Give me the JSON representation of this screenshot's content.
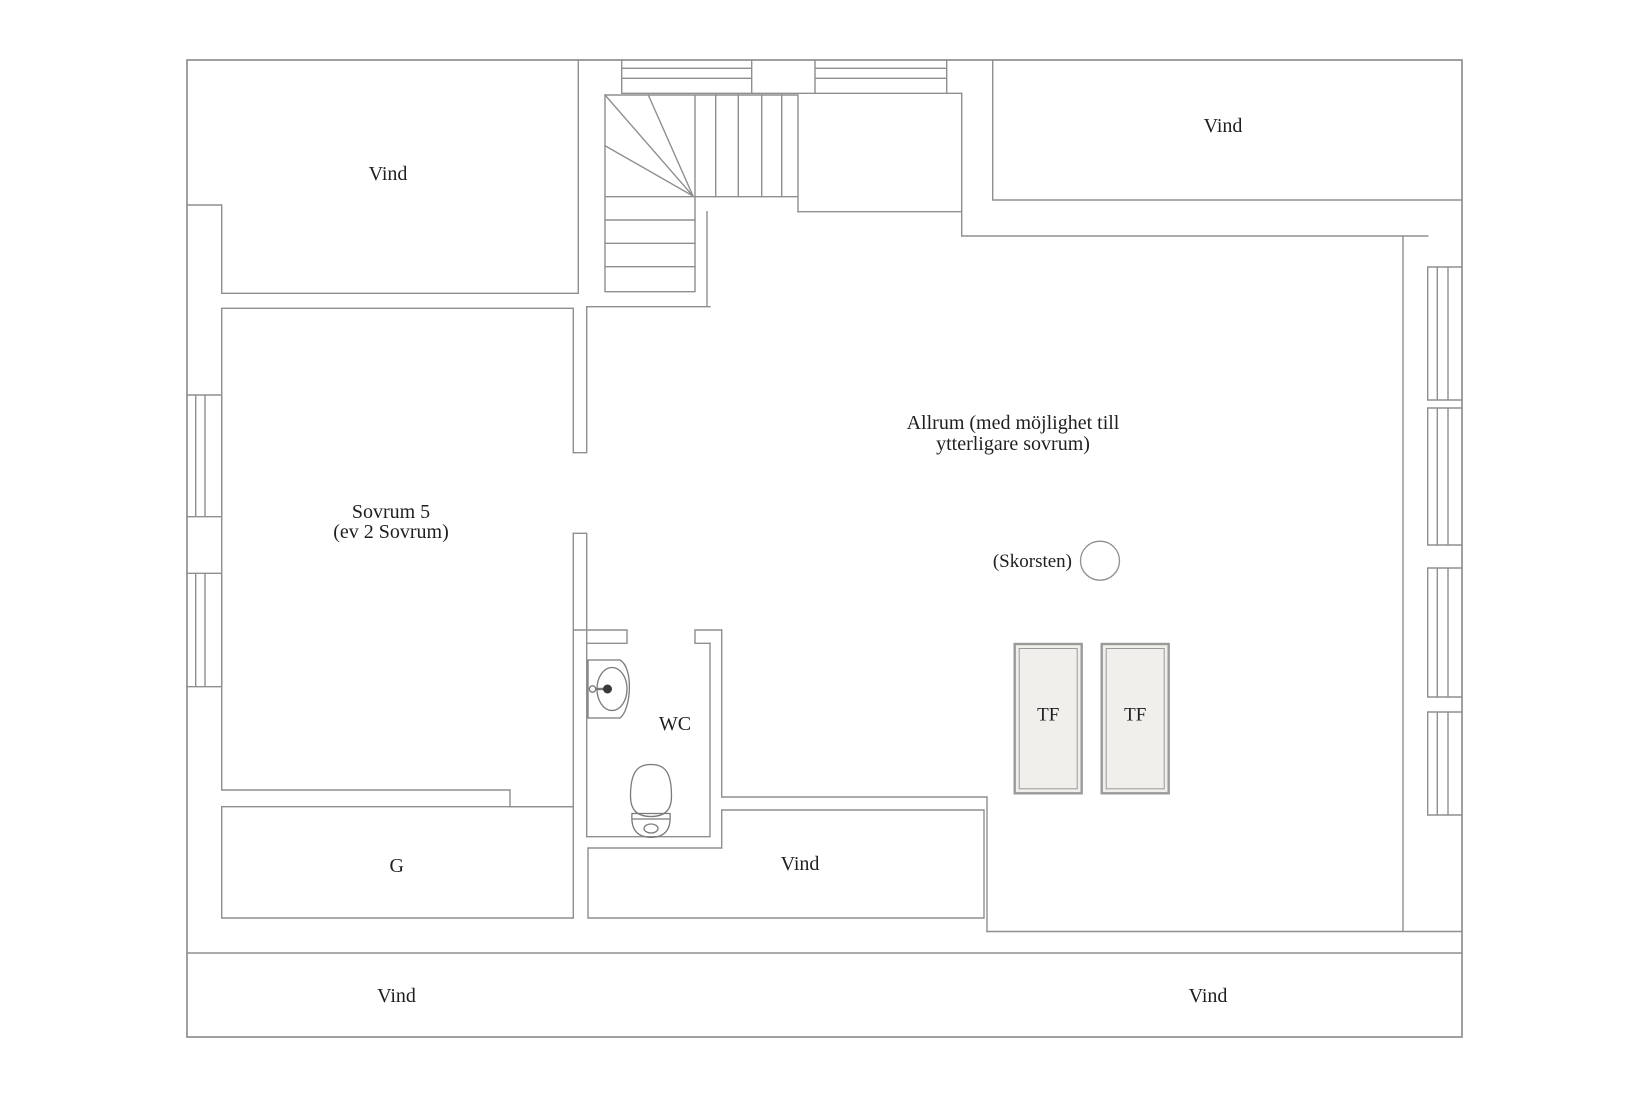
{
  "colors": {
    "wall": "#8f8f8f",
    "fixture": "#7a7a7a",
    "text": "#1f1f1f",
    "skylight_fill": "#f0efec",
    "skylight_border": "#9a9a9a",
    "background": "#ffffff"
  },
  "labels": {
    "vind_top_left": "Vind",
    "vind_top_right": "Vind",
    "sovrum_line1": "Sovrum 5",
    "sovrum_line2": "(ev 2 Sovrum)",
    "allrum_line1": "Allrum (med möjlighet till",
    "allrum_line2": "ytterligare sovrum)",
    "skorsten": "(Skorsten)",
    "wc": "WC",
    "tf_left": "TF",
    "tf_right": "TF",
    "garderob": "G",
    "vind_middle": "Vind",
    "vind_bottom_left": "Vind",
    "vind_bottom_right": "Vind"
  }
}
